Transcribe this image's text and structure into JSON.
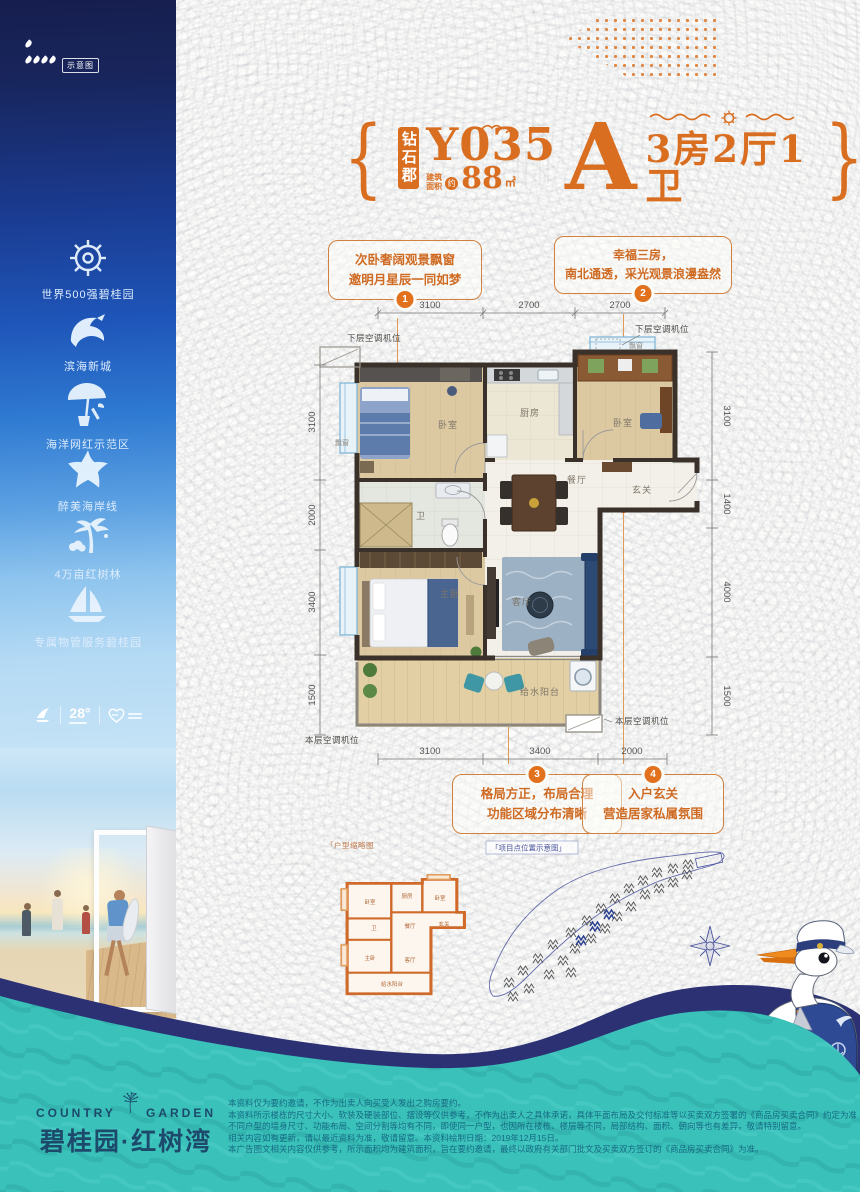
{
  "page": {
    "accent_orange": "#D96E20",
    "teal": "#38BFB9",
    "navy": "#2B3173"
  },
  "sidebar": {
    "tag": "示意图",
    "features": [
      {
        "icon": "helm-icon",
        "label": "世界500强碧桂园"
      },
      {
        "icon": "dolphin-icon",
        "label": "滨海新城"
      },
      {
        "icon": "umbrella-icon",
        "label": "海洋网红示范区"
      },
      {
        "icon": "starfish-icon",
        "label": "醉美海岸线"
      },
      {
        "icon": "palm-icon",
        "label": "4万亩红树林"
      },
      {
        "icon": "sailboat-icon",
        "label": "专属物管服务碧桂园"
      }
    ],
    "badge_temp": "28°"
  },
  "header": {
    "brand_box": "钻石郡",
    "model": "Y035",
    "area_label_1": "建筑",
    "area_label_2": "面积",
    "area_approx": "约",
    "area_value": "88",
    "area_unit": "㎡",
    "unit_letter": "A",
    "layout_spec": "3房2厅1卫"
  },
  "callouts": [
    {
      "num": "1",
      "line1": "次卧奢阔观景飘窗",
      "line2": "邀明月星辰一同如梦"
    },
    {
      "num": "2",
      "line1": "幸福三房，",
      "line2": "南北通透，采光观景浪漫盎然"
    },
    {
      "num": "3",
      "line1": "格局方正，布局合理",
      "line2": "功能区域分布清晰"
    },
    {
      "num": "4",
      "line1": "入户玄关",
      "line2": "营造居家私属氛围"
    }
  ],
  "floorplan": {
    "dims": {
      "top": [
        "3100",
        "2700",
        "2700"
      ],
      "bottom": [
        "3100",
        "3400",
        "2000"
      ],
      "left": [
        "3100",
        "2000",
        "3400",
        "1500"
      ],
      "right": [
        "3100",
        "1400",
        "4000",
        "1500"
      ]
    },
    "labels": {
      "ac_upper": "下层空调机位",
      "ac_lower": "本层空调机位",
      "bay": "飘窗",
      "bedroom": "卧室",
      "kitchen": "厨房",
      "dining": "餐厅",
      "entry": "玄关",
      "bath": "卫",
      "master": "主卧",
      "living": "客厅",
      "balcony": "给水阳台"
    }
  },
  "thumbnail": {
    "label": "「户型缩略图"
  },
  "siteplan": {
    "label": "「项目点位置示意图」"
  },
  "footer": {
    "brand_en_left": "COUNTRY",
    "brand_en_right": "GARDEN",
    "brand_cn": "碧桂园·红树湾",
    "disclaimer": [
      "本资料仅为要约邀请，不作为出卖人向买受人发出之购房要约。",
      "本资料所示楼栋的尺寸大小、软装及硬装部位、摆设等仅供参考，不作为出卖人之具体承诺，具体平面布局及交付标准等以买卖双方签署的《商品房买卖合同》约定为准。",
      "不同户型的墙身尺寸、功能布局、空间分割等均有不同，即使同一户型，也因所在楼栋、楼层等不同，局部结构、面积、朝向等也有差异，敬请特别留意。",
      "相关内容如有更新，请以最近资料为准，敬请留意。本资料绘制日期：2019年12月15日。",
      "本广告图文相关内容仅供参考，所示面积均为建筑面积，旨在要约邀请，最终以政府有关部门批文及买卖双方签订的《商品房买卖合同》为准。"
    ]
  }
}
